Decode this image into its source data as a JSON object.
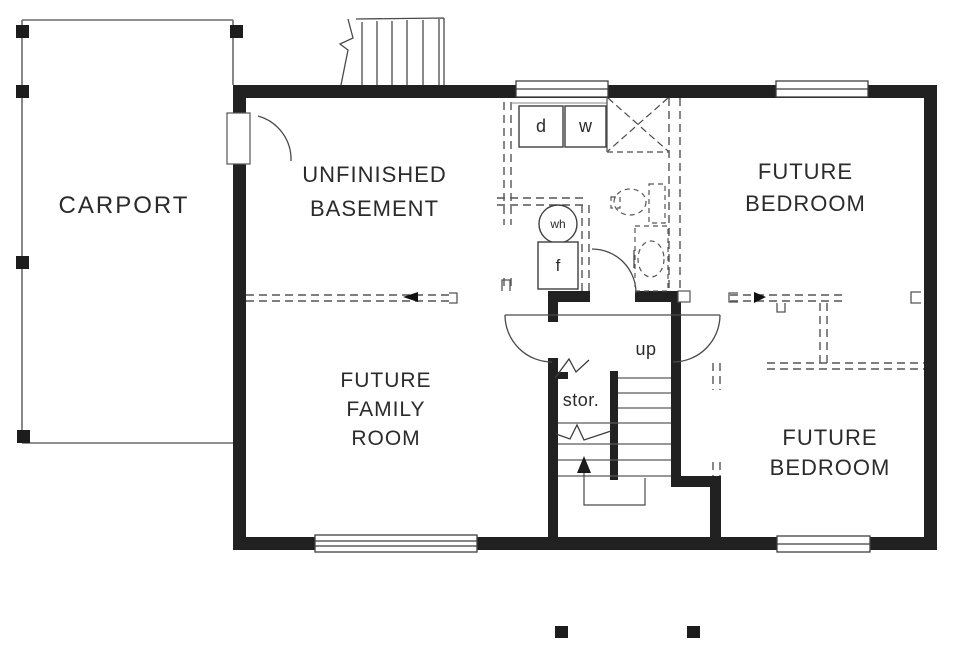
{
  "plan_title": "basement floor plan",
  "rooms": {
    "carport": "CARPORT",
    "basement": "UNFINISHED\nBASEMENT",
    "bedroom_top": "FUTURE\nBEDROOM",
    "family": "FUTURE\nFAMILY\nROOM",
    "bedroom_bottom": "FUTURE\nBEDROOM"
  },
  "annotations": {
    "up": "up",
    "storage": "stor.",
    "dryer": "d",
    "washer": "w",
    "water_heater": "wh",
    "furnace": "f"
  },
  "colors": {
    "wall": "#212121",
    "thin_line": "#4a4a4a",
    "dashed_line": "#555555",
    "text": "#2b2b2b",
    "background": "#ffffff"
  }
}
